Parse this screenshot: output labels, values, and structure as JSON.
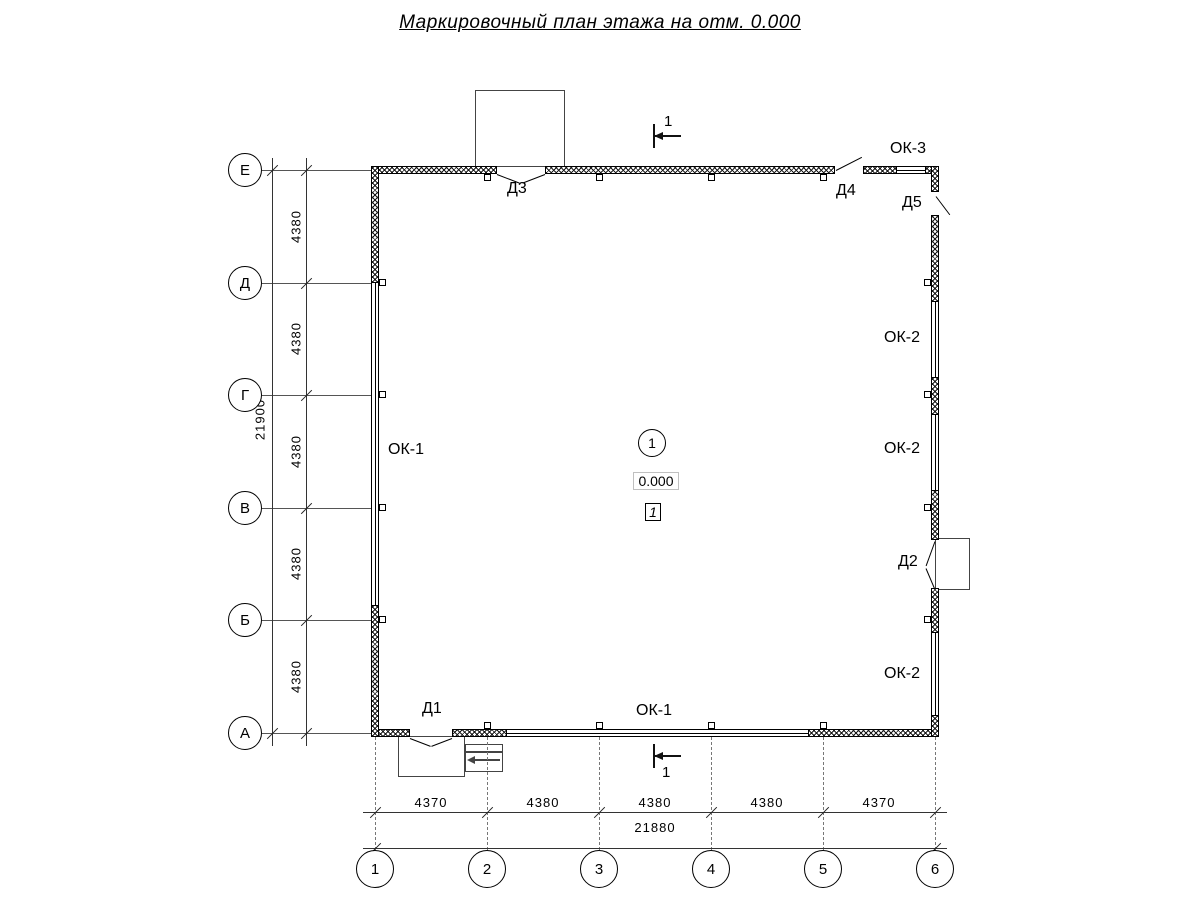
{
  "title": "Маркировочный план этажа на отм. 0.000",
  "grid": {
    "rows": [
      "Е",
      "Д",
      "Г",
      "В",
      "Б",
      "А"
    ],
    "cols": [
      "1",
      "2",
      "3",
      "4",
      "5",
      "6"
    ]
  },
  "dimensions": {
    "left_total": "21900",
    "left_segments": [
      "4380",
      "4380",
      "4380",
      "4380",
      "4380"
    ],
    "bottom_segments": [
      "4370",
      "4380",
      "4380",
      "4380",
      "4370"
    ],
    "bottom_total": "21880"
  },
  "labels": {
    "d1": "Д1",
    "d2": "Д2",
    "d3": "Д3",
    "d4": "Д4",
    "d5": "Д5",
    "ok1_left": "ОК-1",
    "ok1_bottom": "ОК-1",
    "ok2_upper": "ОК-2",
    "ok2_middle": "ОК-2",
    "ok2_lower": "ОК-2",
    "ok3": "ОК-3"
  },
  "room": {
    "number": "1",
    "elevation": "0.000",
    "zone": "1"
  },
  "section": {
    "top": "1",
    "bottom": "1"
  },
  "colors": {
    "line": "#000000",
    "dim_line": "#333333",
    "porch_line": "#444444"
  }
}
